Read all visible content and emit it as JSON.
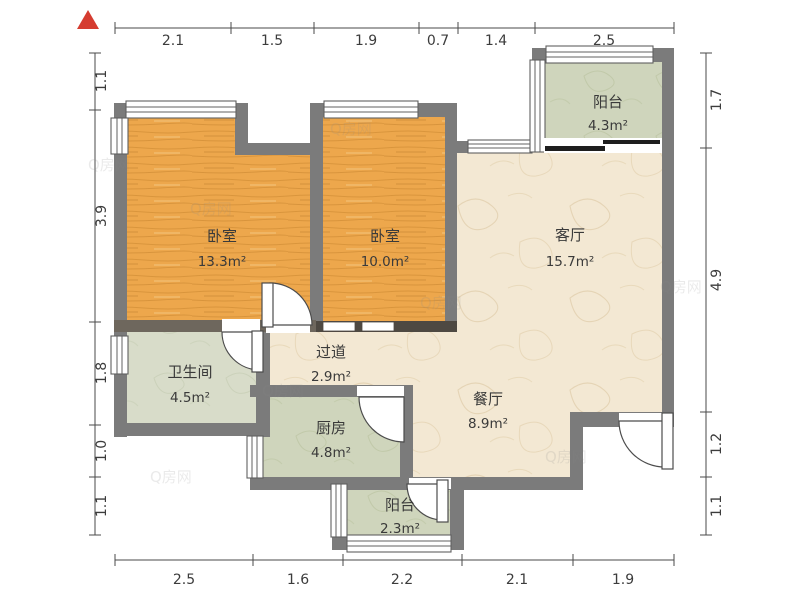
{
  "title": "apartment-floor-plan",
  "watermark": {
    "text": "Q房网"
  },
  "icons": {
    "north_arrow": "north-triangle-icon"
  },
  "colors": {
    "wall": "#7b7b7b",
    "dark_wall": "#68625a",
    "wood_floor": "#eda74c",
    "marble_floor": "#f3e8d3",
    "tile_floor": "#cfd5bc",
    "bath_floor": "#d8dcc9",
    "north_arrow": "#d53c30"
  },
  "rooms": [
    {
      "id": "bedroom-1",
      "name": "卧室",
      "area": "13.3m²"
    },
    {
      "id": "bedroom-2",
      "name": "卧室",
      "area": "10.0m²"
    },
    {
      "id": "living-room",
      "name": "客厅",
      "area": "15.7m²"
    },
    {
      "id": "balcony-top",
      "name": "阳台",
      "area": "4.3m²"
    },
    {
      "id": "bathroom",
      "name": "卫生间",
      "area": "4.5m²"
    },
    {
      "id": "hallway",
      "name": "过道",
      "area": "2.9m²"
    },
    {
      "id": "kitchen",
      "name": "厨房",
      "area": "4.8m²"
    },
    {
      "id": "dining-room",
      "name": "餐厅",
      "area": "8.9m²"
    },
    {
      "id": "balcony-bottom",
      "name": "阳台",
      "area": "2.3m²"
    }
  ],
  "dimensions": {
    "top": [
      "2.1",
      "1.5",
      "1.9",
      "0.7",
      "1.4",
      "2.5"
    ],
    "bottom": [
      "2.5",
      "1.6",
      "2.2",
      "2.1",
      "1.9"
    ],
    "left": [
      "1.1",
      "3.9",
      "1.8",
      "1.0",
      "1.1"
    ],
    "right": [
      "1.7",
      "4.9",
      "1.2",
      "1.1"
    ]
  }
}
